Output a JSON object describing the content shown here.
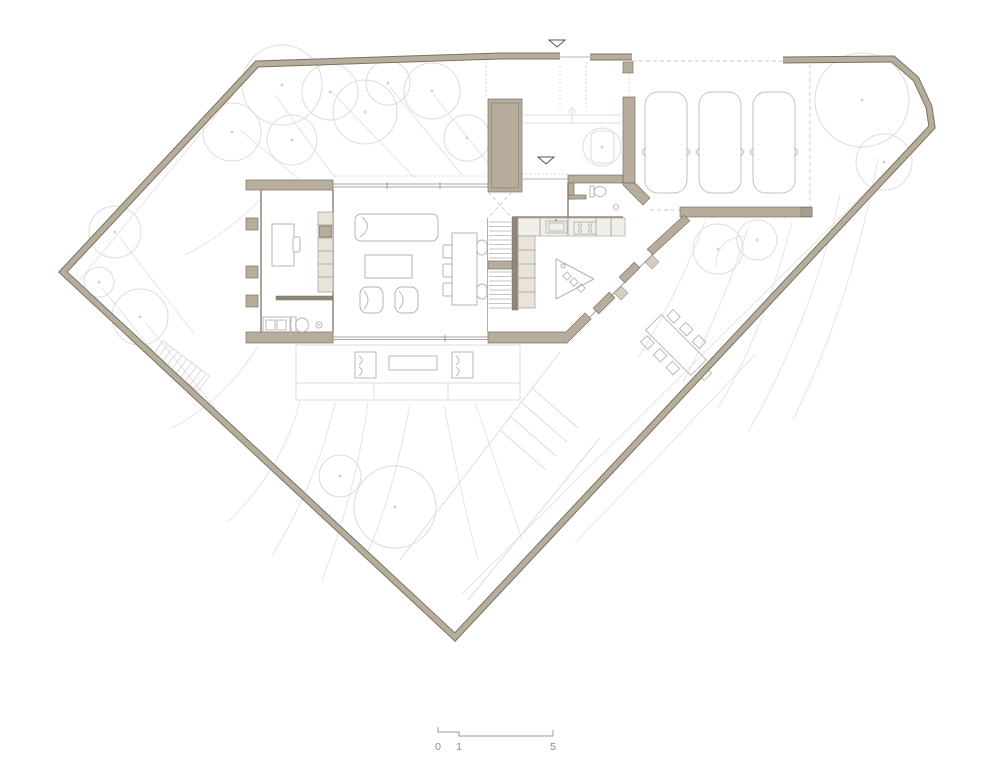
{
  "drawing": {
    "type": "architectural-floor-plan",
    "floor": "ground-floor-site-plan",
    "car_count": 3
  },
  "scale_bar": {
    "labels": [
      "0",
      "1",
      "5"
    ]
  },
  "colors": {
    "background": "#ffffff",
    "wall_fill": "#b7ad9c",
    "wall_edge": "#7a7264",
    "wall_dark": "#8f8778",
    "cabinet_fill": "#e8e4da",
    "counter_fill": "#f1efe9",
    "furniture_line": "#b3b3b3",
    "car_line": "#c2c2c2",
    "landscape_line": "#dcdcdc",
    "contour_line": "#e5e5e5",
    "interior_wall": "#7c766b",
    "dash_line": "#c9c9c9",
    "scale_text": "#8a8a8a"
  }
}
